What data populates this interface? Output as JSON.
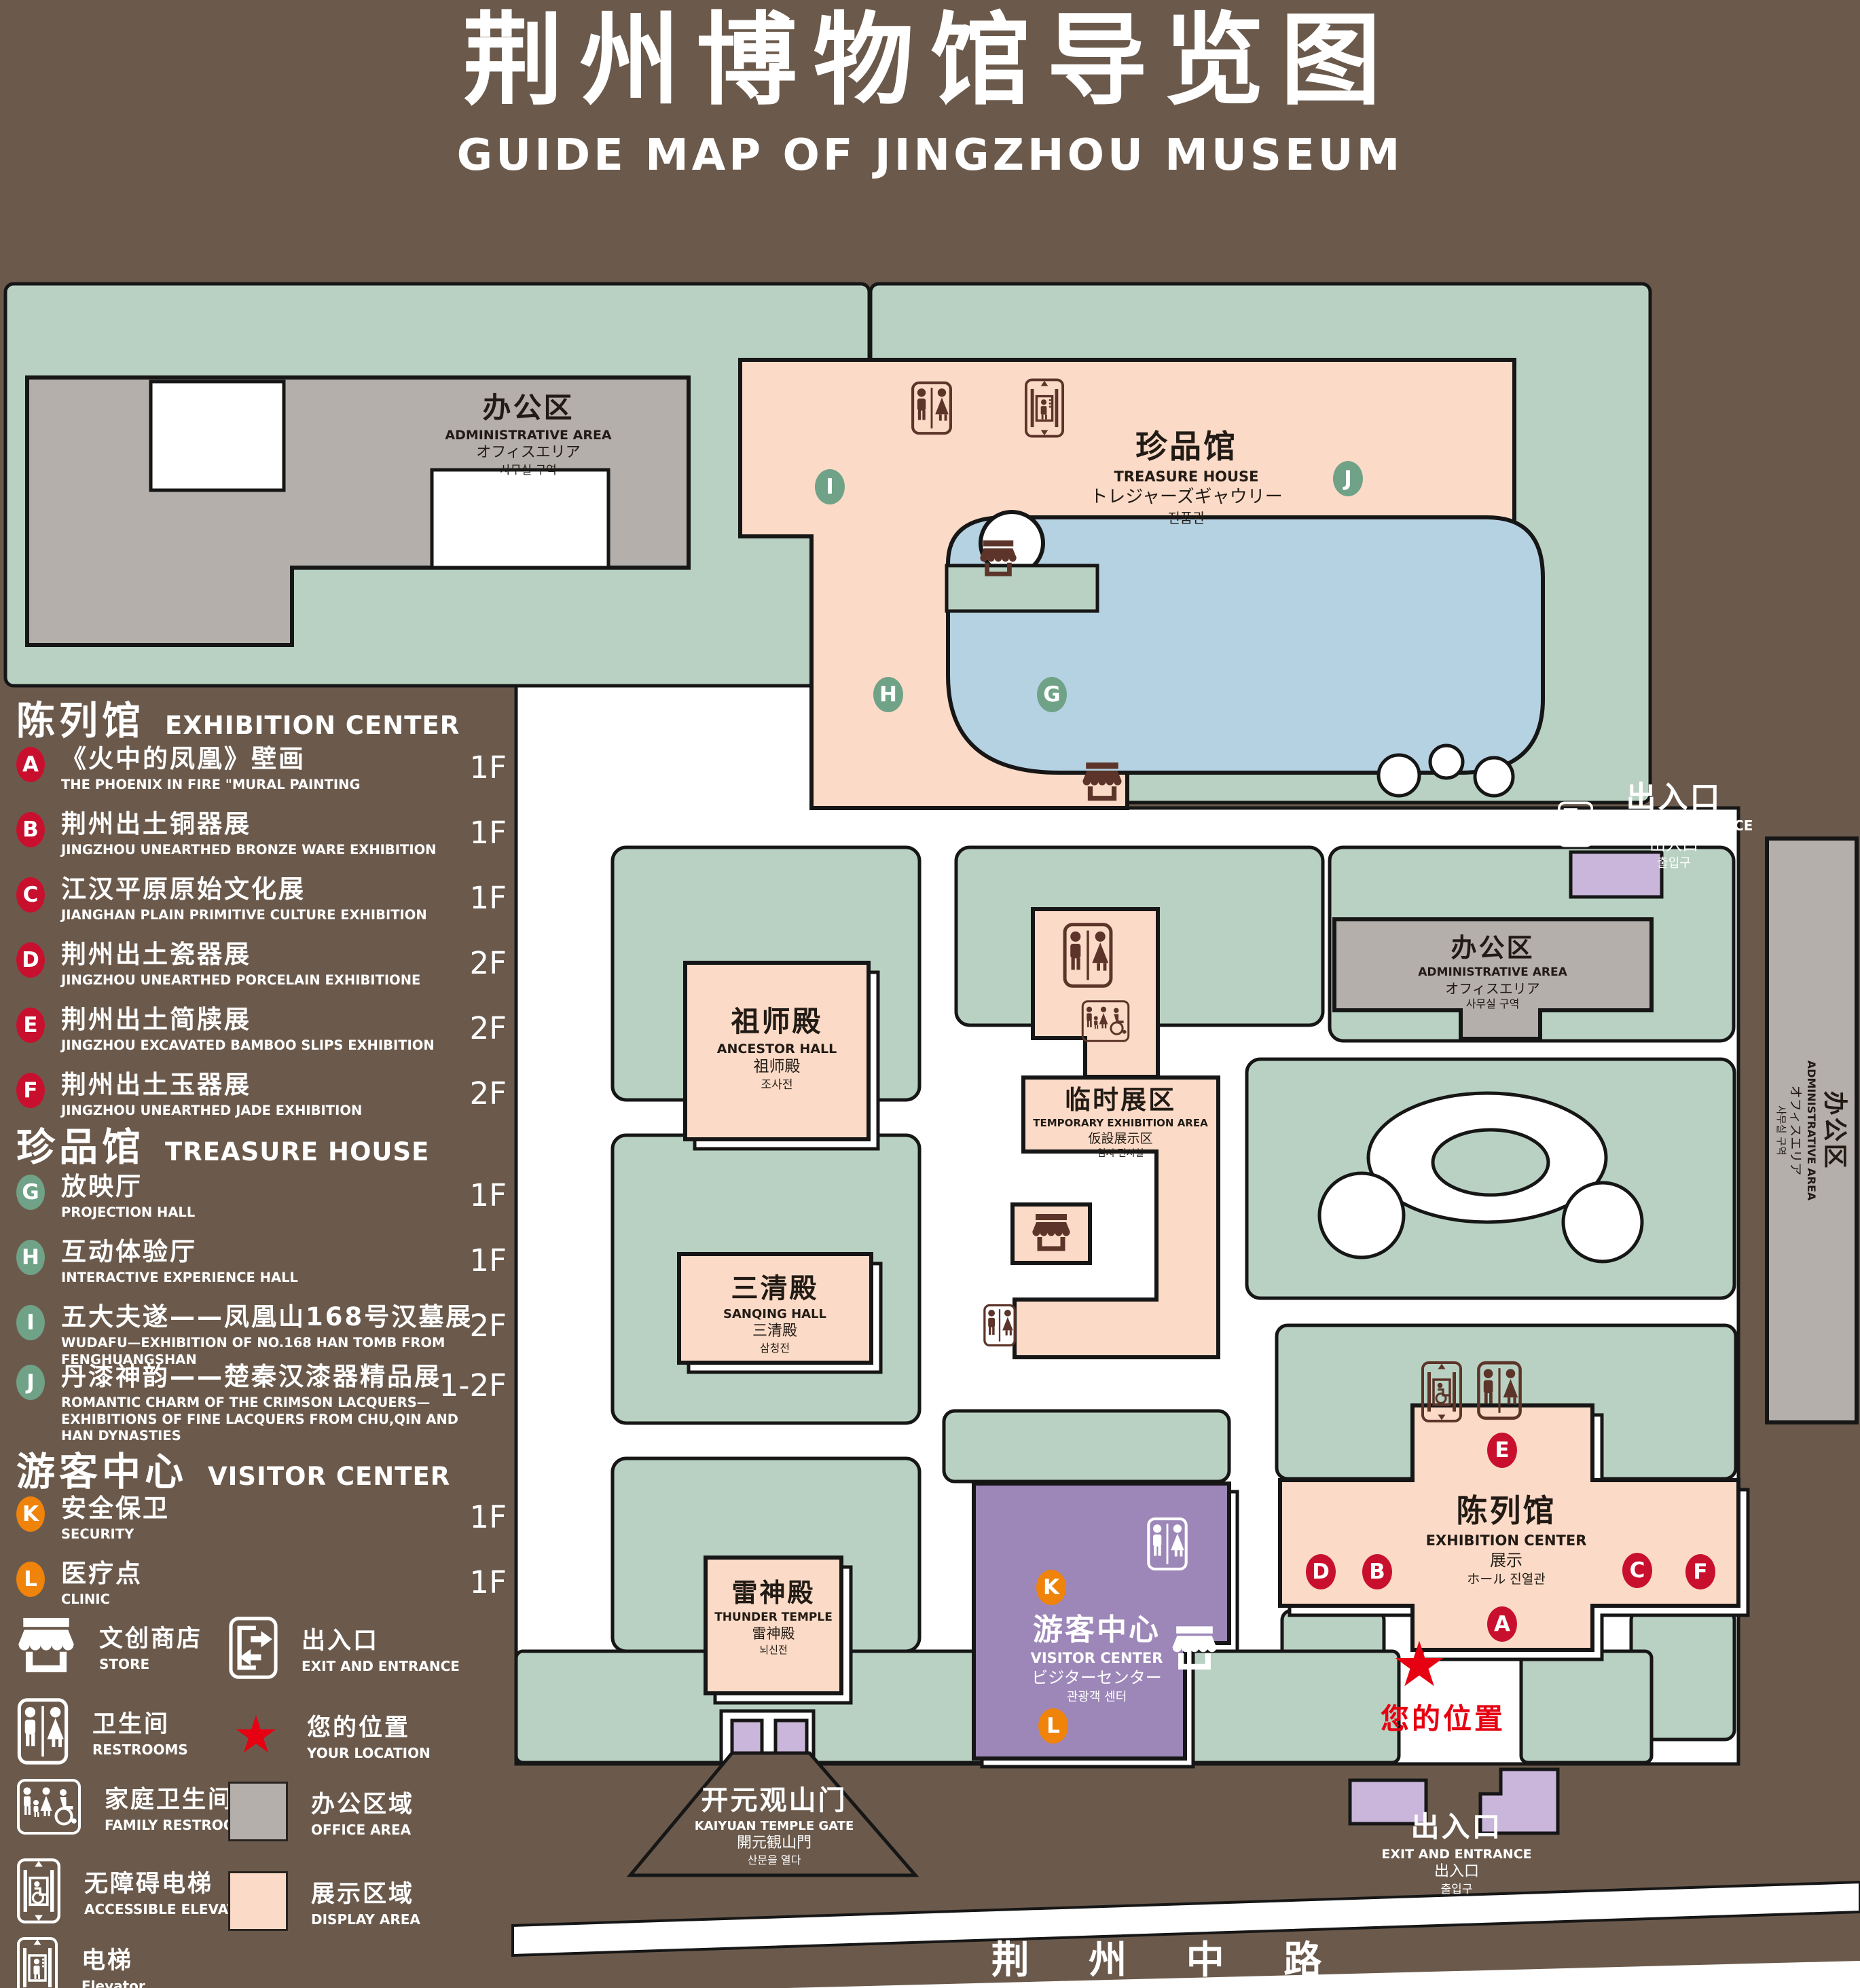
{
  "title": {
    "cn": "荆州博物馆导览图",
    "en": "GUIDE MAP OF JINGZHOU MUSEUM"
  },
  "legend": {
    "sections": [
      {
        "cn": "陈列馆",
        "en": "EXHIBITION CENTER",
        "items": [
          {
            "id": "A",
            "cn": "《火中的凤凰》壁画",
            "en": "THE PHOENIX IN FIRE \"MURAL PAINTING",
            "floor": "1F"
          },
          {
            "id": "B",
            "cn": "荆州出土铜器展",
            "en": "JINGZHOU UNEARTHED BRONZE WARE EXHIBITION",
            "floor": "1F"
          },
          {
            "id": "C",
            "cn": "江汉平原原始文化展",
            "en": "JIANGHAN PLAIN PRIMITIVE CULTURE EXHIBITION",
            "floor": "1F"
          },
          {
            "id": "D",
            "cn": "荆州出土瓷器展",
            "en": "JINGZHOU UNEARTHED PORCELAIN EXHIBITIONE",
            "floor": "2F"
          },
          {
            "id": "E",
            "cn": "荆州出土简牍展",
            "en": "JINGZHOU EXCAVATED BAMBOO SLIPS EXHIBITION",
            "floor": "2F"
          },
          {
            "id": "F",
            "cn": "荆州出土玉器展",
            "en": "JINGZHOU UNEARTHED JADE EXHIBITION",
            "floor": "2F"
          }
        ]
      },
      {
        "cn": "珍品馆",
        "en": "TREASURE HOUSE",
        "items": [
          {
            "id": "G",
            "cn": "放映厅",
            "en": "PROJECTION HALL",
            "floor": "1F"
          },
          {
            "id": "H",
            "cn": "互动体验厅",
            "en": "INTERACTIVE EXPERIENCE HALL",
            "floor": "1F"
          },
          {
            "id": "I",
            "cn": "五大夫遂——凤凰山168号汉墓展",
            "en": "WUDAFU—EXHIBITION OF NO.168 HAN TOMB FROM FENGHUANGSHAN",
            "floor": "2F"
          },
          {
            "id": "J",
            "cn": "丹漆神韵——楚秦汉漆器精品展",
            "en": "ROMANTIC CHARM OF THE CRIMSON LACQUERS—EXHIBITIONS OF FINE LACQUERS FROM CHU,QIN AND HAN DYNASTIES",
            "floor": "1-2F"
          }
        ]
      },
      {
        "cn": "游客中心",
        "en": "VISITOR CENTER",
        "items": [
          {
            "id": "K",
            "cn": "安全保卫",
            "en": "SECURITY",
            "floor": "1F"
          },
          {
            "id": "L",
            "cn": "医疗点",
            "en": "CLINIC",
            "floor": "1F"
          }
        ]
      }
    ],
    "symbols_left": [
      {
        "icon": "store-icon",
        "cn": "文创商店",
        "en": "STORE"
      },
      {
        "icon": "restroom-icon",
        "cn": "卫生间",
        "en": "RESTROOMS"
      },
      {
        "icon": "family-restroom-icon",
        "cn": "家庭卫生间",
        "en": "FAMILY RESTROOMS"
      },
      {
        "icon": "accessible-elevator-icon",
        "cn": "无障碍电梯",
        "en": "ACCESSIBLE ELEVATOR"
      },
      {
        "icon": "elevator-icon",
        "cn": "电梯",
        "en": "Elevator"
      }
    ],
    "symbols_right": [
      {
        "icon": "exit-icon",
        "cn": "出入口",
        "en": "EXIT AND ENTRANCE"
      },
      {
        "icon": "your-location-icon",
        "cn": "您的位置",
        "en": "YOUR LOCATION"
      },
      {
        "icon": "office-area-swatch",
        "cn": "办公区域",
        "en": "OFFICE AREA"
      },
      {
        "icon": "display-area-swatch",
        "cn": "展示区域",
        "en": "DISPLAY AREA"
      }
    ]
  },
  "map": {
    "admin_nw": {
      "cn": "办公区",
      "en": "ADMINISTRATIVE AREA",
      "jp": "オフィスエリア",
      "kr": "사무실 구역"
    },
    "treasure_house": {
      "cn": "珍品馆",
      "en": "TREASURE HOUSE",
      "jp": "トレジャーズギャウリー",
      "kr": "진품관"
    },
    "ancestor_hall": {
      "cn": "祖师殿",
      "en": "ANCESTOR HALL",
      "jp": "祖师殿",
      "kr": "조사전"
    },
    "temporary_exhibition": {
      "cn": "临时展区",
      "en": "TEMPORARY EXHIBITION AREA",
      "jp": "仮設展示区",
      "kr": "임시 전시실"
    },
    "sanqing_hall": {
      "cn": "三清殿",
      "en": "SANQING HALL",
      "jp": "三清殿",
      "kr": "삼청전"
    },
    "thunder_temple": {
      "cn": "雷神殿",
      "en": "THUNDER TEMPLE",
      "jp": "雷神殿",
      "kr": "뇌신전"
    },
    "admin_e": {
      "cn": "办公区",
      "en": "ADMINISTRATIVE AREA",
      "jp": "オフィスエリア",
      "kr": "사무실 구역"
    },
    "admin_strip": {
      "cn": "办公区",
      "en": "ADMINISTRATIVE AREA",
      "jp": "オフィスエリア",
      "kr": "사무실 구역"
    },
    "exhibition_center": {
      "cn": "陈列馆",
      "en": "EXHIBITION CENTER",
      "jp": "展示",
      "kr": "ホール 진열관"
    },
    "visitor_center": {
      "cn": "游客中心",
      "en": "VISITOR CENTER",
      "jp": "ビジターセンター",
      "kr": "관광객 센터"
    },
    "exit_ne": {
      "cn": "出入口",
      "en": "EXIT AND ENTRANCE",
      "jp": "出入口",
      "kr": "출입구"
    },
    "exit_s": {
      "cn": "出入口",
      "en": "EXIT AND ENTRANCE",
      "jp": "出入口",
      "kr": "출입구"
    },
    "gate": {
      "cn": "开元观山门",
      "en": "KAIYUAN TEMPLE GATE",
      "jp": "開元観山門",
      "kr": "산문을 열다"
    },
    "road": "荆 州 中 路",
    "your_location": "您的位置"
  },
  "colors": {
    "background": "#6b5a4c",
    "garden": "#b9d1c2",
    "display_area": "#fbdbc7",
    "office_area": "#b4afaa",
    "visitor_center": "#9d87b8",
    "gate_building": "#c9b6da",
    "pond": "#b5d2e2",
    "marker_red": "#c8102e",
    "marker_green": "#6fa287",
    "marker_orange": "#f0830a",
    "icon_brown": "#5c3429",
    "location_red": "#e60012"
  }
}
